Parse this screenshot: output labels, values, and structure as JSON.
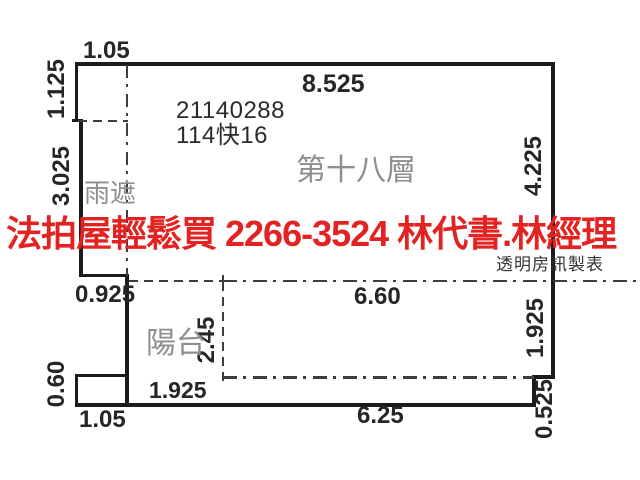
{
  "plan": {
    "case": {
      "number": "21140288",
      "code": "114快16"
    },
    "labels": {
      "floor": "第十八層",
      "rain_canopy": "雨遮",
      "balcony": "陽台"
    },
    "dims": {
      "top_left_width": "1.05",
      "top_width": "8.525",
      "left_upper_height": "1.125",
      "left_canopy_height": "3.025",
      "right_height": "4.225",
      "canopy_bottom_width": "0.925",
      "balcony_top_width": "6.60",
      "balcony_depth": "2.45",
      "balcony_right_height": "1.925",
      "bottom_left_box_height": "0.60",
      "balcony_left_width": "1.925",
      "bottom_left_box_width": "1.05",
      "balcony_bottom_width": "6.25",
      "bottom_right_step_height": "0.525"
    }
  },
  "watermark": {
    "text": "法拍屋輕鬆買  2266-3524  林代書.林經理",
    "color": "#e32222"
  },
  "credit": {
    "text": "透明房訊製表"
  },
  "colors": {
    "background": "#ffffff",
    "wall": "#1b1b1b",
    "dash_line": "#3d3d3d",
    "dim_text": "#262626",
    "room_label": "#8e8e8e",
    "watermark_red": "#e32222",
    "credit_text": "#333333"
  }
}
